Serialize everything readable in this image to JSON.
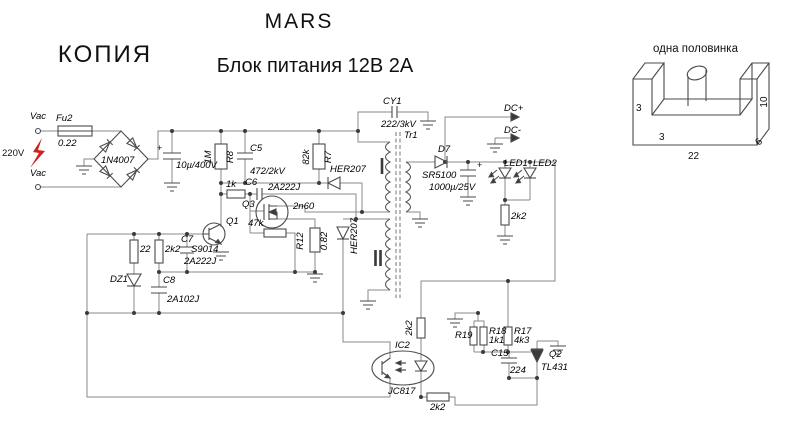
{
  "titles": {
    "brand": "MARS",
    "stamp": "КОПИЯ",
    "subtitle": "Блок питания 12В 2А"
  },
  "core": {
    "caption": "одна полов+инка",
    "leg": "3",
    "inner": "3",
    "height": "10",
    "width": "22",
    "depth": "6"
  },
  "c": {
    "vac1": "Vac",
    "vac2": "Vac",
    "mains": "220V",
    "fu2": "Fu2",
    "fu2v": "0.22",
    "bridge": "1N4007",
    "cin": "10µ/400V",
    "plus": "+",
    "r8": "R8",
    "r8v": "1M",
    "c5": "C5",
    "c5v": "472/2kV",
    "r1k": "1k",
    "c6": "C6",
    "c6v": "2A222J",
    "r7": "R7",
    "r7v": "82k",
    "dsnub": "HER207",
    "q3": "Q3",
    "q3v": "2n60",
    "r47k": "47k",
    "q1": "Q1",
    "q1v": "S9014",
    "c7": "C7",
    "c7v": "2A222J",
    "rb1": "2k2",
    "r22": "22",
    "dz1": "DZ1",
    "c8": "C8",
    "c8v": "2A102J",
    "r12": "R12",
    "r12v": "0.82",
    "daux": "HER207",
    "cy1": "CY1",
    "cy1v": "222/3kV",
    "tr1": "Tr1",
    "d7": "D7",
    "d7v": "SR5100",
    "cout": "1000µ/25V",
    "dcp": "DC+",
    "dcm": "DC-",
    "led1": "LED1",
    "led2": "LED2",
    "rled": "2k2",
    "rfb": "2k2",
    "ic2": "IC2",
    "ic2v": "JC817",
    "ropto": "2k2",
    "r19": "R19",
    "r18": "R18",
    "r18v": "1k1",
    "r17": "R17",
    "r17v": "4k3",
    "c15": "C15",
    "c15v": "224",
    "q2": "Q2",
    "q2v": "TL431"
  },
  "colors": {
    "wire": "#8a8a8a",
    "component": "#4a4a4a",
    "text": "#000000",
    "stamp_bolt": "#cc2222",
    "background": "#ffffff"
  }
}
